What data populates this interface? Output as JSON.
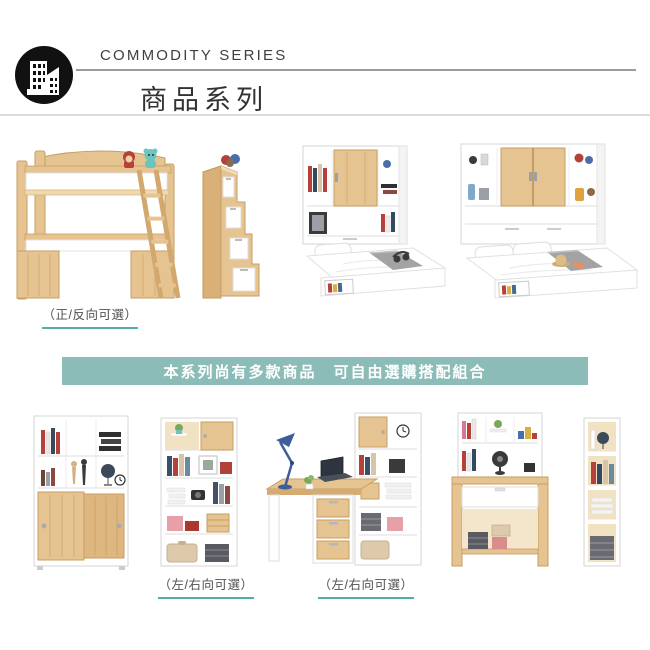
{
  "header": {
    "series_en": "COMMODITY SERIES",
    "series_zh": "商品系列",
    "logo_icon": "buildings-icon"
  },
  "banner": {
    "text": "本系列尚有多款商品　可自由選購搭配組合",
    "background": "#8cbcb8",
    "text_color": "#ffffff"
  },
  "captions": {
    "row1_direction": "（正/反向可選）",
    "row2_left_direction": "（左/右向可選）",
    "row2_right_direction": "（左/右向可選）",
    "underline_color": "#56aca9",
    "text_color": "#4f4f4f"
  },
  "products": {
    "row1": [
      "loft-bed",
      "stair-storage-cabinet",
      "single-bed-bookcase-headboard",
      "double-bed-bookcase-headboard"
    ],
    "row2": [
      "sliding-door-bookcase",
      "open-bookshelf",
      "l-shaped-desk-bookshelf-combo",
      "desk-with-hutch",
      "narrow-bookshelf"
    ]
  },
  "colors": {
    "wood": "#e6c492",
    "wood_dark": "#c89e63",
    "furniture_white": "#ffffff",
    "blanket_gray": "#a3a3a3",
    "header_rule": "#9c9c9c",
    "section_divider": "#dcdcdc",
    "text_dark": "#3f3f3f"
  }
}
